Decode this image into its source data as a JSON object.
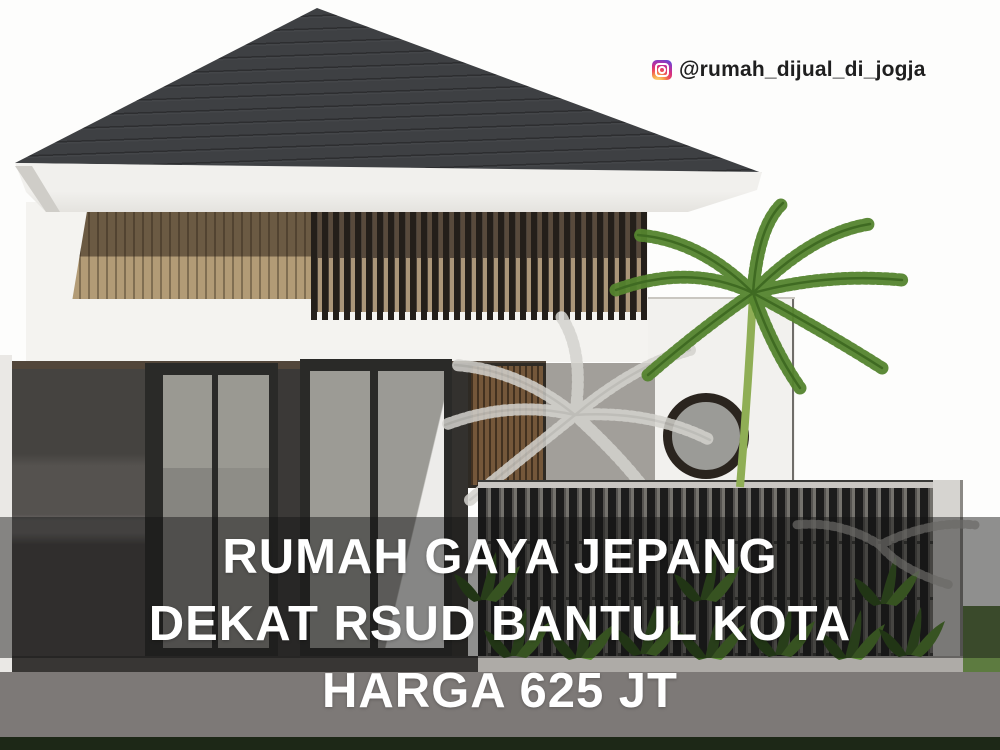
{
  "watermark": {
    "handle_label": "@rumah_dijual_di_jogja",
    "icon": "instagram-icon"
  },
  "caption": {
    "lines": [
      "RUMAH GAYA JEPANG",
      "DEKAT RSUD BANTUL KOTA",
      "HARGA 625 JT"
    ],
    "text_color": "#ffffff",
    "overlay_color": "rgba(20,20,20,0.47)"
  },
  "palette": {
    "roof": "#3e4043",
    "fascia": "#f1f0ed",
    "wood_dark": "#6b5a43",
    "wood_light": "#b29b76",
    "wall_white": "#f4f3f0",
    "wall_dark": "#454340",
    "glass": "#96958f",
    "fence_slat": "#1c1c1c",
    "palm_green": "#5b8f35",
    "bottom_wall": "#7d7977"
  },
  "scene": {
    "elements": [
      "hip-roof",
      "balcony-wood-panel",
      "wood-slat-screen",
      "glass-doors",
      "wood-louvre-panel",
      "round-window",
      "palm-tree",
      "palm-shadow",
      "slatted-fence",
      "garden-plants",
      "boundary-wall",
      "grass-strip"
    ]
  }
}
